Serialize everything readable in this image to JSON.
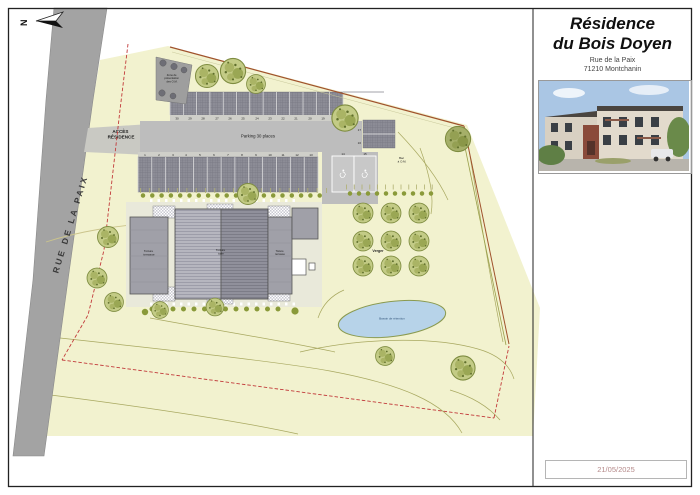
{
  "titleblock": {
    "title_line1": "Résidence",
    "title_line2": "du Bois Doyen",
    "address_line1": "Rue de la Paix",
    "address_line2": "71210 Montchanin",
    "date": "21/05/2025"
  },
  "plan": {
    "north_label": "N",
    "road_name": "RUE DE LA PAIX",
    "access_lines": [
      "ACCÈS",
      "RÉSIDENCE"
    ],
    "parking_label": "Parking 30 places",
    "waste_zone_lines": [
      "Zone de",
      "présentation",
      "des O.M."
    ],
    "bin_lines": [
      "Bac",
      "à O.M."
    ],
    "orchard_label": "Verger",
    "basin_label": "Bassin de rétention",
    "roof_terrace_lines": [
      "Toiture",
      "terrasse"
    ],
    "roof_tile_lines": [
      "Toiture",
      "tuile"
    ],
    "numbers_top": [
      "30",
      "29",
      "28",
      "27",
      "26",
      "25",
      "24",
      "23",
      "22",
      "21",
      "20",
      "19",
      "18"
    ],
    "numbers_bottom": [
      "1",
      "2",
      "3",
      "4",
      "5",
      "6",
      "7",
      "8",
      "9",
      "10",
      "11",
      "12",
      "13"
    ],
    "numbers_side": [
      "17",
      "16"
    ],
    "numbers_handicap": [
      "14",
      "15"
    ]
  },
  "colors": {
    "terrain": "#f2f2cf",
    "road": "#a3a3a3",
    "parking_dark": "#8c8c96",
    "building": "#a0a0a8",
    "water": "#b7d3e9",
    "boundary_red": "#c23b3b",
    "tree_green": "#c3cb86"
  }
}
